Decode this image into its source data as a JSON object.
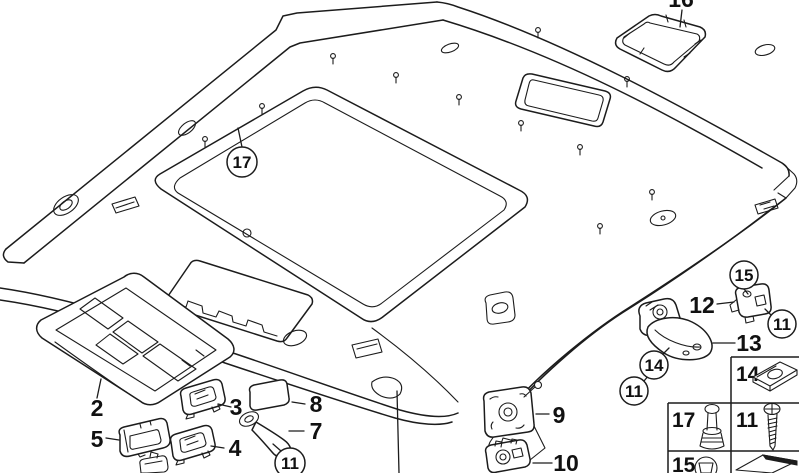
{
  "colors": {
    "background": "#ffffff",
    "line_art": "#1c1c1c",
    "label_text": "#111111"
  },
  "callouts": {
    "c2": "2",
    "c3": "3",
    "c4": "4",
    "c5": "5",
    "c7": "7",
    "c8": "8",
    "c9": "9",
    "c10": "10",
    "c12": "12",
    "c13": "13",
    "c16": "16",
    "c17": "17",
    "c15": "15",
    "c14": "14",
    "c11a": "11",
    "c11b": "11",
    "c11c": "11"
  },
  "fastener_table": {
    "cell_14": "14",
    "cell_17": "17",
    "cell_11": "11",
    "cell_15": "15"
  }
}
